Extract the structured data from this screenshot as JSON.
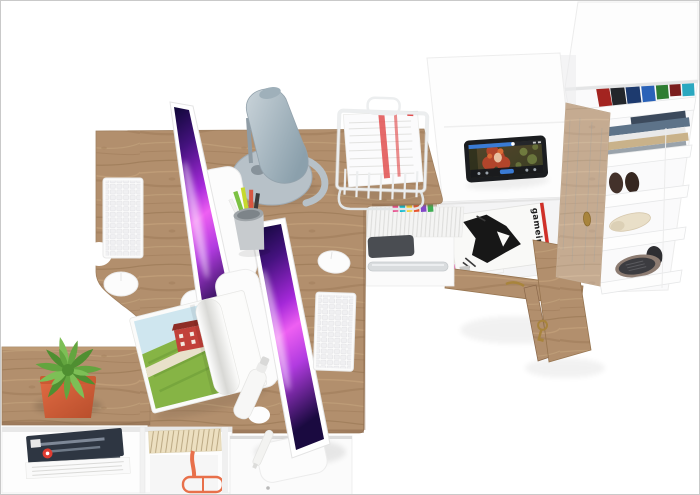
{
  "scene": {
    "kind": "3D furniture product render, top-down view",
    "description": "Two-person home office set: oak double desk with two iMac computers, designer lamp, document tray, white storage cabinets, open magazine drawer, open wardrobe with shoes and clothes, bench with plant and bookshelf",
    "visible_text": [
      "gameinformer"
    ]
  },
  "palette": {
    "background": "#ffffff",
    "border": "#c9c9c9",
    "wood_base": "#b28f6d",
    "wood_grain_dark": "#8f6c49",
    "wood_grain_light": "#cbaa82",
    "wood_edge": "#8a684b",
    "white_furniture": "#fcfcfc",
    "line": "#e9e9e9",
    "brass": "#a8843c",
    "pc": "#4a4d52",
    "rail": "#d9dcde"
  },
  "desk_area": {
    "keyboard": {
      "body": "#fbfbfb",
      "key": "#f0f0f2"
    },
    "mouse": {
      "body": "#fcfcfc"
    },
    "imac": {
      "chassis": "#fcfcfc",
      "logo": "#d0d5d9",
      "screen_stops": [
        "#0e0736",
        "#44127e",
        "#a428d8",
        "#ee5ff2",
        "#b13be0",
        "#1a0a40"
      ]
    },
    "lamp": {
      "cone_light": "#c9d3d9",
      "cone_dark": "#8ba0ac",
      "base": "#b7c1c8",
      "arm": "#8f9ca5"
    },
    "pen_cup": {
      "cup": "#c7cbce",
      "rim": "#9fa5a9",
      "pencils": [
        "#7cc243",
        "#c6d92e",
        "#d85540",
        "#3b3b3b",
        "#f2f2f0"
      ]
    },
    "open_magazine": {
      "page": "#fbfbfa",
      "sky": "#cfe6ef",
      "grass": "#86b445",
      "grass_dark": "#6e9c38",
      "path": "#e8e1ca",
      "barn": "#c2413a",
      "roof": "#8e2d26"
    },
    "document_tray": {
      "wire": "#eceeef",
      "paper": "#fbfbfc",
      "stripe_red": "#e25050"
    },
    "spray_bottle": "#f7f7f6",
    "shelf_row": {
      "spine": "#f4f4f3",
      "tops": [
        "#e84a8a",
        "#00b7ce",
        "#f7cf2e",
        "#e8542e",
        "#8248c8",
        "#3fae54"
      ]
    }
  },
  "right_cabinet": {
    "tablet": {
      "bezel": "#1b1d20",
      "bg_stops": [
        "#55452a",
        "#3a3f24"
      ],
      "progress_blue": "#3a7bd5",
      "control_bar": "#14161c",
      "hair": "#b2452b",
      "hair_light": "#d96a35",
      "skin": "#e8c0a0",
      "bokeh": "#8aa04e"
    },
    "drawer": {
      "magazine_title": "gameinformer",
      "cover": "#f9f9f7",
      "ink": "#171717",
      "red": "#d03028",
      "edge_colors": [
        "#f5d533",
        "#e0459a",
        "#232323",
        "#f7f7f7"
      ]
    }
  },
  "wardrobe": {
    "books": [
      "#a32420",
      "#23262b",
      "#1d3a6e",
      "#2a62b8",
      "#2e7d32",
      "#7a1d1d",
      "#2aa8c0"
    ],
    "clothes": [
      "#5d7389",
      "#e9e9e9",
      "#c9b28a",
      "#9aa3ab",
      "#3c4a5c"
    ],
    "slipper": "#43312a",
    "slipper_dark": "#362720",
    "heel": "#e9dfc8",
    "sneaker": "#3c3c40",
    "sneaker_sole": "#8d7c72"
  },
  "bottom_left": {
    "magazine_cover": "#2e3642",
    "magazine_streak": "#8c97a6",
    "logo_red": "#e03c31",
    "papers": "#fafafa",
    "pages_tan": "#ecdfc0",
    "pages_line": "#a6916a",
    "glasses_orange": "#e8704a"
  },
  "plant": {
    "leaf_dark": "#4f8f31",
    "leaf_mid": "#63a53f",
    "leaf_light": "#7dbf56",
    "pot_light": "#e06a42",
    "pot_dark": "#b84e2c",
    "rim": "#cb5a33"
  }
}
